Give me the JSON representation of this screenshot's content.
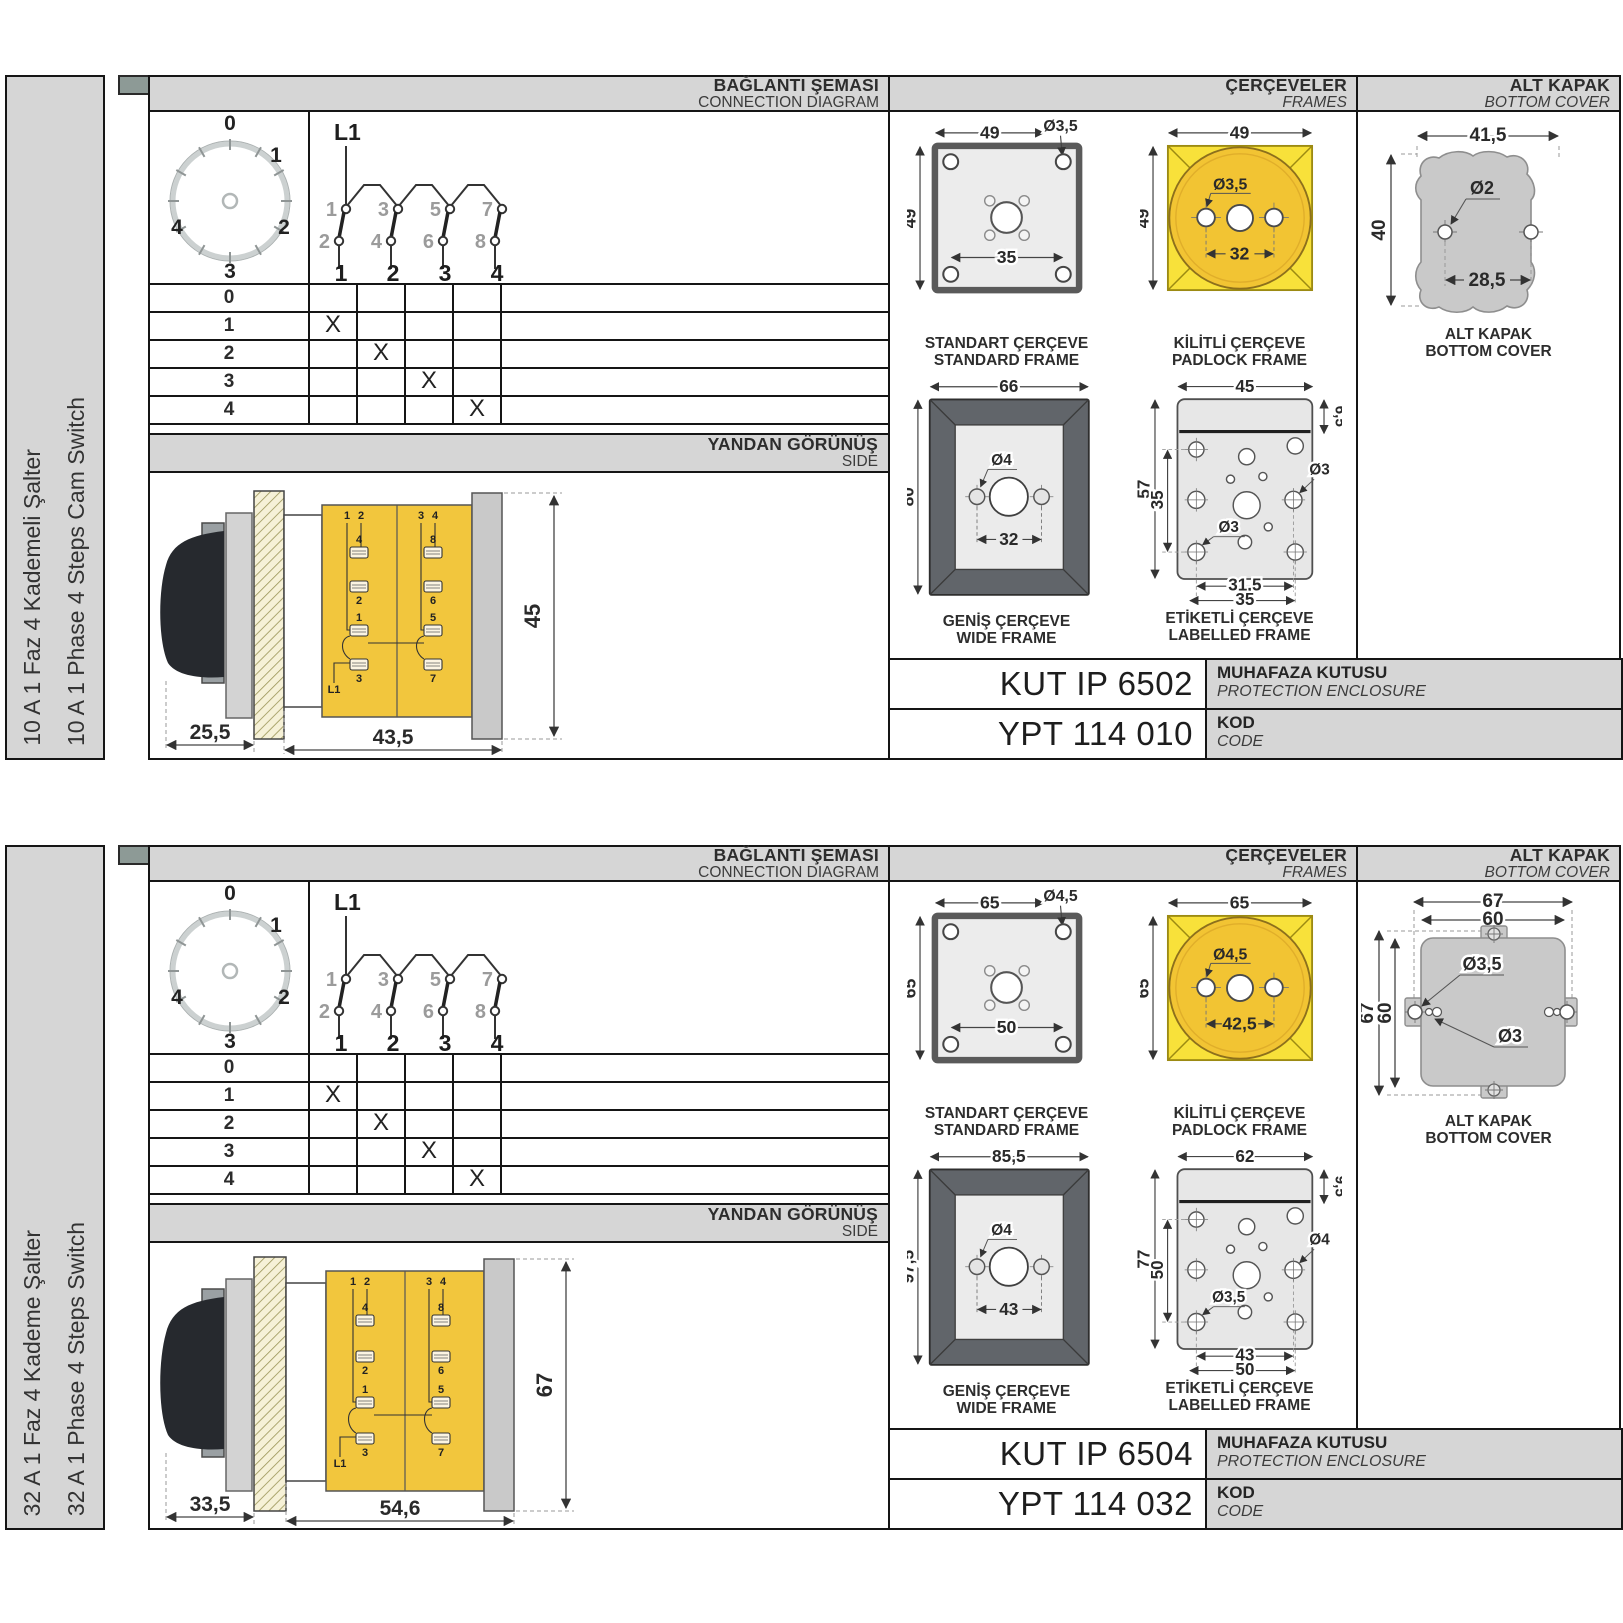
{
  "colors": {
    "accent_yellow": "#F2C63D",
    "padlock_yellow": "#F8E13A",
    "band_gray": "#D6D6D6",
    "line_dark": "#151515",
    "cover_gray": "#C9C9C9"
  },
  "sections": [
    {
      "sidebar": {
        "tr": "10 A 1 Faz 4 Kademeli Şalter",
        "en": "10 A 1 Phase 4 Steps Cam Switch"
      },
      "headers": {
        "conn_tr": "BAĞLANTI ŞEMASI",
        "conn_en": "CONNECTION DIAGRAM",
        "frames_tr": "ÇERÇEVELER",
        "frames_en": "FRAMES",
        "cover_tr": "ALT KAPAK",
        "cover_en": "BOTTOM COVER"
      },
      "dial": {
        "labels": [
          "0",
          "1",
          "2",
          "3",
          "4"
        ]
      },
      "contact": {
        "l1": "L1",
        "top": [
          "1",
          "3",
          "5",
          "7"
        ],
        "bottom": [
          "2",
          "4",
          "6",
          "8"
        ],
        "positions": [
          "1",
          "2",
          "3",
          "4"
        ]
      },
      "table": {
        "rows": [
          {
            "label": "0",
            "marks": [
              "",
              "",
              "",
              ""
            ]
          },
          {
            "label": "1",
            "marks": [
              "X",
              "",
              "",
              ""
            ]
          },
          {
            "label": "2",
            "marks": [
              "",
              "X",
              "",
              ""
            ]
          },
          {
            "label": "3",
            "marks": [
              "",
              "",
              "X",
              ""
            ]
          },
          {
            "label": "4",
            "marks": [
              "",
              "",
              "",
              "X"
            ]
          }
        ]
      },
      "side": {
        "band_tr": "YANDAN GÖRÜNÜŞ",
        "band_en": "SIDE",
        "dim_a": "25,5",
        "dim_b": "43,5",
        "dim_h": "45",
        "block": {
          "tl1": "1",
          "tl2": "2",
          "tr1": "3",
          "tr2": "4",
          "l_top": "4",
          "l_mid": "2",
          "l_low": "1",
          "l_bot": "3",
          "r_top": "8",
          "r_mid": "6",
          "r_low": "5",
          "r_bot": "7",
          "l1": "L1"
        }
      },
      "frames": {
        "standard": {
          "tr": "STANDART ÇERÇEVE",
          "en": "STANDARD FRAME",
          "w": "49",
          "h": "49",
          "hole": "Ø3,5",
          "inner": "35"
        },
        "padlock": {
          "tr": "KİLİTLİ ÇERÇEVE",
          "en": "PADLOCK FRAME",
          "w": "49",
          "h": "49",
          "hole": "Ø3,5",
          "inner": "32"
        },
        "wide": {
          "tr": "GENİŞ ÇERÇEVE",
          "en": "WIDE FRAME",
          "w": "66",
          "h": "80",
          "hole": "Ø4",
          "inner": "32"
        },
        "labelled": {
          "tr": "ETİKETLİ ÇERÇEVE",
          "en": "LABELLED FRAME",
          "w": "45",
          "top": "6,5",
          "h": "57",
          "h2": "35",
          "hole_r": "Ø3",
          "hole_b": "Ø3",
          "b1": "31,5",
          "b2": "35"
        }
      },
      "cover": {
        "tr": "ALT KAPAK",
        "en": "BOTTOM COVER",
        "w": "41,5",
        "h": "40",
        "hole": "Ø2",
        "inner": "28,5"
      },
      "codes": [
        {
          "value": "KUT IP 6502",
          "tr": "MUHAFAZA KUTUSU",
          "en": "PROTECTION ENCLOSURE"
        },
        {
          "value": "YPT 114 010",
          "tr": "KOD",
          "en": "CODE"
        }
      ]
    },
    {
      "sidebar": {
        "tr": "32 A 1 Faz 4 Kademe Şalter",
        "en": "32 A 1 Phase 4 Steps Switch"
      },
      "headers": {
        "conn_tr": "BAĞLANTI ŞEMASI",
        "conn_en": "CONNECTION DIAGRAM",
        "frames_tr": "ÇERÇEVELER",
        "frames_en": "FRAMES",
        "cover_tr": "ALT KAPAK",
        "cover_en": "BOTTOM COVER"
      },
      "dial": {
        "labels": [
          "0",
          "1",
          "2",
          "3",
          "4"
        ]
      },
      "contact": {
        "l1": "L1",
        "top": [
          "1",
          "3",
          "5",
          "7"
        ],
        "bottom": [
          "2",
          "4",
          "6",
          "8"
        ],
        "positions": [
          "1",
          "2",
          "3",
          "4"
        ]
      },
      "table": {
        "rows": [
          {
            "label": "0",
            "marks": [
              "",
              "",
              "",
              ""
            ]
          },
          {
            "label": "1",
            "marks": [
              "X",
              "",
              "",
              ""
            ]
          },
          {
            "label": "2",
            "marks": [
              "",
              "X",
              "",
              ""
            ]
          },
          {
            "label": "3",
            "marks": [
              "",
              "",
              "X",
              ""
            ]
          },
          {
            "label": "4",
            "marks": [
              "",
              "",
              "",
              "X"
            ]
          }
        ]
      },
      "side": {
        "band_tr": "YANDAN GÖRÜNÜŞ",
        "band_en": "SIDE",
        "dim_a": "33,5",
        "dim_b": "54,6",
        "dim_h": "67",
        "block": {
          "tl1": "1",
          "tl2": "2",
          "tr1": "3",
          "tr2": "4",
          "l_top": "4",
          "l_mid": "2",
          "l_low": "1",
          "l_bot": "3",
          "r_top": "8",
          "r_mid": "6",
          "r_low": "5",
          "r_bot": "7",
          "l1": "L1"
        }
      },
      "frames": {
        "standard": {
          "tr": "STANDART ÇERÇEVE",
          "en": "STANDARD FRAME",
          "w": "65",
          "h": "65",
          "hole": "Ø4,5",
          "inner": "50"
        },
        "padlock": {
          "tr": "KİLİTLİ ÇERÇEVE",
          "en": "PADLOCK FRAME",
          "w": "65",
          "h": "65",
          "hole": "Ø4,5",
          "inner": "42,5"
        },
        "wide": {
          "tr": "GENİŞ ÇERÇEVE",
          "en": "WIDE FRAME",
          "w": "85,5",
          "h": "97,5",
          "hole": "Ø4",
          "inner": "43"
        },
        "labelled": {
          "tr": "ETİKETLİ ÇERÇEVE",
          "en": "LABELLED FRAME",
          "w": "62",
          "top": "9,5",
          "h": "77",
          "h2": "50",
          "hole_r": "Ø4",
          "hole_b": "Ø3,5",
          "b1": "43",
          "b2": "50"
        }
      },
      "cover": {
        "tr": "ALT KAPAK",
        "en": "BOTTOM COVER",
        "w1": "67",
        "w2": "60",
        "h1": "67",
        "h2": "60",
        "hole1": "Ø3,5",
        "hole2": "Ø3"
      },
      "codes": [
        {
          "value": "KUT IP 6504",
          "tr": "MUHAFAZA KUTUSU",
          "en": "PROTECTION ENCLOSURE"
        },
        {
          "value": "YPT 114 032",
          "tr": "KOD",
          "en": "CODE"
        }
      ]
    }
  ]
}
